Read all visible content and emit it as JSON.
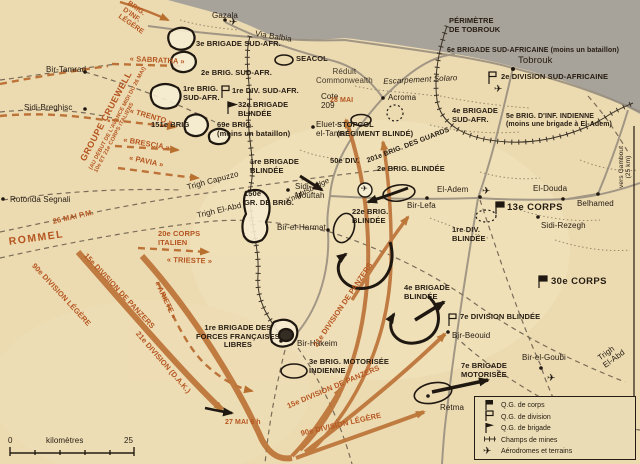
{
  "colors": {
    "paper": "#ecdab1",
    "sea": "#a7a29a",
    "ink": "#251c12",
    "axis_orange_text": "#b5551f",
    "arrow_orange": "#c07a40",
    "road_grey": "#948b7c"
  },
  "labels": {
    "places": {
      "gazala": "Gazala",
      "via_balbia": "Via Balbia",
      "bir_tamrad": "Bir-Tamrad",
      "sidi_breghisc": "Sidi-Breghisc",
      "rotonda_segnali": "Rotonda Segnali",
      "tobrouk": "Tobrouk",
      "acroma": "Acroma",
      "eluet_el_tamar": "Eluet-\nel-Tamar",
      "sidi_mouftah": "Sidi-\nMouftah",
      "knightsbridge": "Knightsbridge",
      "bir_el_harmat": "Bir-el-Harmat",
      "el_adem": "El-Adem",
      "el_douda": "El-Douda",
      "belhamed": "Belhamed",
      "sidi_rezegh": "Sidi-Rezegh",
      "bir_lefa": "Bir-Lefa",
      "bir_hakeim": "Bir-Hakeim",
      "bir_beouid": "Bir-Beouid",
      "bir_el_goubi": "Bir-el-Goubi",
      "retma": "Retma",
      "escarpement_solaro": "Escarpement Solaro",
      "reduit_commonwealth": "Réduit\nCommonwealth",
      "cote_209": "Cote\n209",
      "vers_gambout": "vers Gambout\n(25 km)",
      "trigh_capuzzo": "Trigh Capuzzo",
      "trigh_el_abd_ouest": "Trigh El-Abd",
      "trigh_el_abd_sudest": "Trigh\nEl-Abd"
    },
    "allied": {
      "brigade3_sudafr": "3e BRIGADE SUD-AFR.",
      "brig2_sudafr": "2e BRIG. SUD-AFR.",
      "brig1_sudafr": "1re BRIG.\nSUD-AFR.",
      "div1_sudafr": "1re DIV. SUD-AFR.",
      "brigade32_blindee": "32e BRIGADE\nBLINDÉE",
      "brig151": "151e BRIG",
      "brig69": "69e BRIG.\n(moins un bataillon)",
      "seacol": "SEACOL",
      "perimetre_tobrouk": "PÉRIMÈTRE\nDE TOBROUK",
      "brigade6_sudafricaine": "6e BRIGADE SUD-AFRICAINE (moins un bataillon)",
      "div2_sudafricaine": "2e DIVISION SUD-AFRICAINE",
      "brigade4_sudafr": "4e BRIGADE\nSUD-AFR.",
      "brig5_inf_indienne": "5e BRIG. D'INF. INDIENNE\n(moins une brigade à El-Adem)",
      "stopcol": "STOPCOL\n(RÉGIMENT BLINDÉ)",
      "brigade1_blindee": "1re BRIGADE\nBLINDÉE",
      "div50": "50e DIV.",
      "brig201_guards": "201e BRIG. DES GUARDS",
      "brig2_blindee": "2e BRIG. BLINDÉE",
      "brig22_blindee": "22e BRIG.\nBLINDÉE",
      "gr150": "150e\nGR. DE BRIG.",
      "corps13": "13e CORPS",
      "div1_blindee": "1re DIV.\nBLINDÉE",
      "corps30": "30e CORPS",
      "brigade4_blindee": "4e BRIGADE\nBLINDÉE",
      "div7_blindee": "7e DIVISION BLINDÉE",
      "brigade1_ffl": "1re BRIGADE DES\nFORCES FRANÇAISES\nLIBRES",
      "brig3_motorisee": "3e BRIG. MOTORISÉE\nINDIENNE",
      "brigade7_motorisee": "7e BRIGADE\nMOTORISÉE"
    },
    "axis": {
      "brig_inf_legere": "BRIG.\nD'INF.\nLÉGÈRE",
      "groupe_cruewell": "GROUPE CRUEWELL",
      "groupe_cruewell_sub": "(AU DÉBUT DE L'AVANCE MIDI DU 26 MAI)\n10e ET 21e CORPS ITALIENS",
      "sabratha": "« SABRATHA »",
      "trento": "« TRENTO »",
      "brescia": "« BRESCIA »",
      "pavia": "« PAVIA »",
      "rommel": "ROMMEL",
      "date_26_mai": "26 MAI P.M.",
      "corps20_italien": "20e CORPS\nITALIEN",
      "trieste": "« TRIESTE »",
      "ariete": "« ARIETE »",
      "date_28_mai": "28 MAI",
      "date_27_mai": "27 MAI 6 h",
      "route_90_legere": "90e DIVISION LÉGÈRE",
      "route_15_panzers": "15e DIVISION DE PANZERS",
      "route_21_dak": "21e DIVISION (D.A.K.)",
      "fan_15_panzers": "15e DIVISION DE PANZERS",
      "fan_90_legere": "90e DIVISION LÉGÈRE",
      "fan_21_panzers": "21e DIVISION DE PANZERS"
    }
  },
  "legend": {
    "qg_corps": "Q.G. de corps",
    "qg_division": "Q.G. de division",
    "qg_brigade": "Q.G. de brigade",
    "mines": "Champs de mines",
    "aerodromes": "Aérodromes et terrains"
  },
  "scale": {
    "zero": "0",
    "unit": "kilomètres",
    "max": "25"
  }
}
